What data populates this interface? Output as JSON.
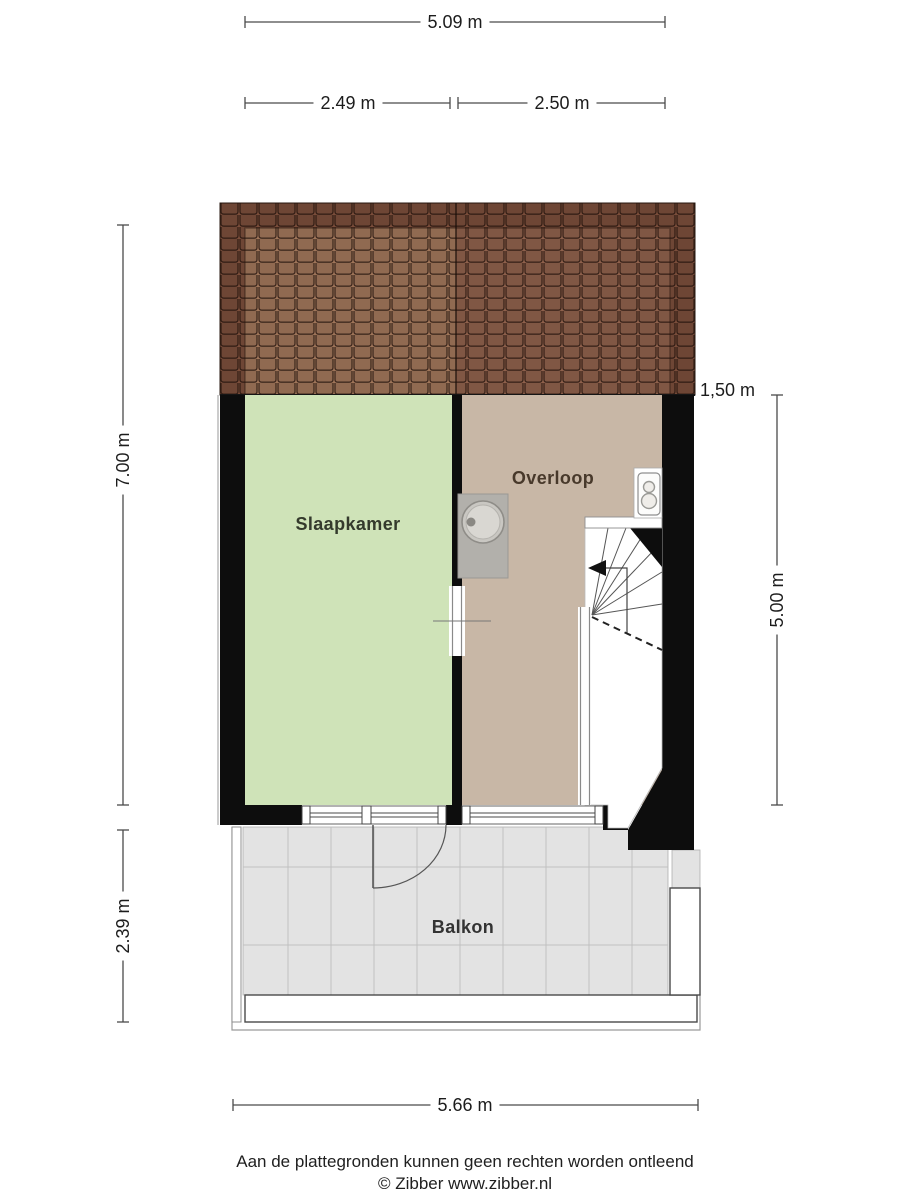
{
  "floorplan": {
    "rooms": {
      "slaapkamer": "Slaapkamer",
      "overloop": "Overloop",
      "balkon": "Balkon"
    },
    "dimensions": {
      "total_width_top": "5.09 m",
      "width_left_section": "2.49 m",
      "width_right_section": "2.50 m",
      "depth_main": "7.00 m",
      "depth_balcony": "2.39 m",
      "knee_wall_height": "1,50 m",
      "stair_zone_depth": "5.00 m",
      "total_width_bottom": "5.66 m"
    },
    "footer": {
      "disclaimer": "Aan de plattegronden kunnen geen rechten worden ontleend",
      "credit": "© Zibber www.zibber.nl"
    },
    "colors": {
      "bedroom_floor": "#cfe3b8",
      "landing_floor": "#c8b7a6",
      "balcony_floor": "#e3e3e3",
      "roof_outer": "#7b4e3b",
      "roof_inner_left": "#a0765a",
      "roof_inner_right": "#8f614c",
      "walls": "#0d0d0d"
    },
    "fixtures": {
      "sink": "wastafel",
      "toilet": "toilet"
    }
  }
}
